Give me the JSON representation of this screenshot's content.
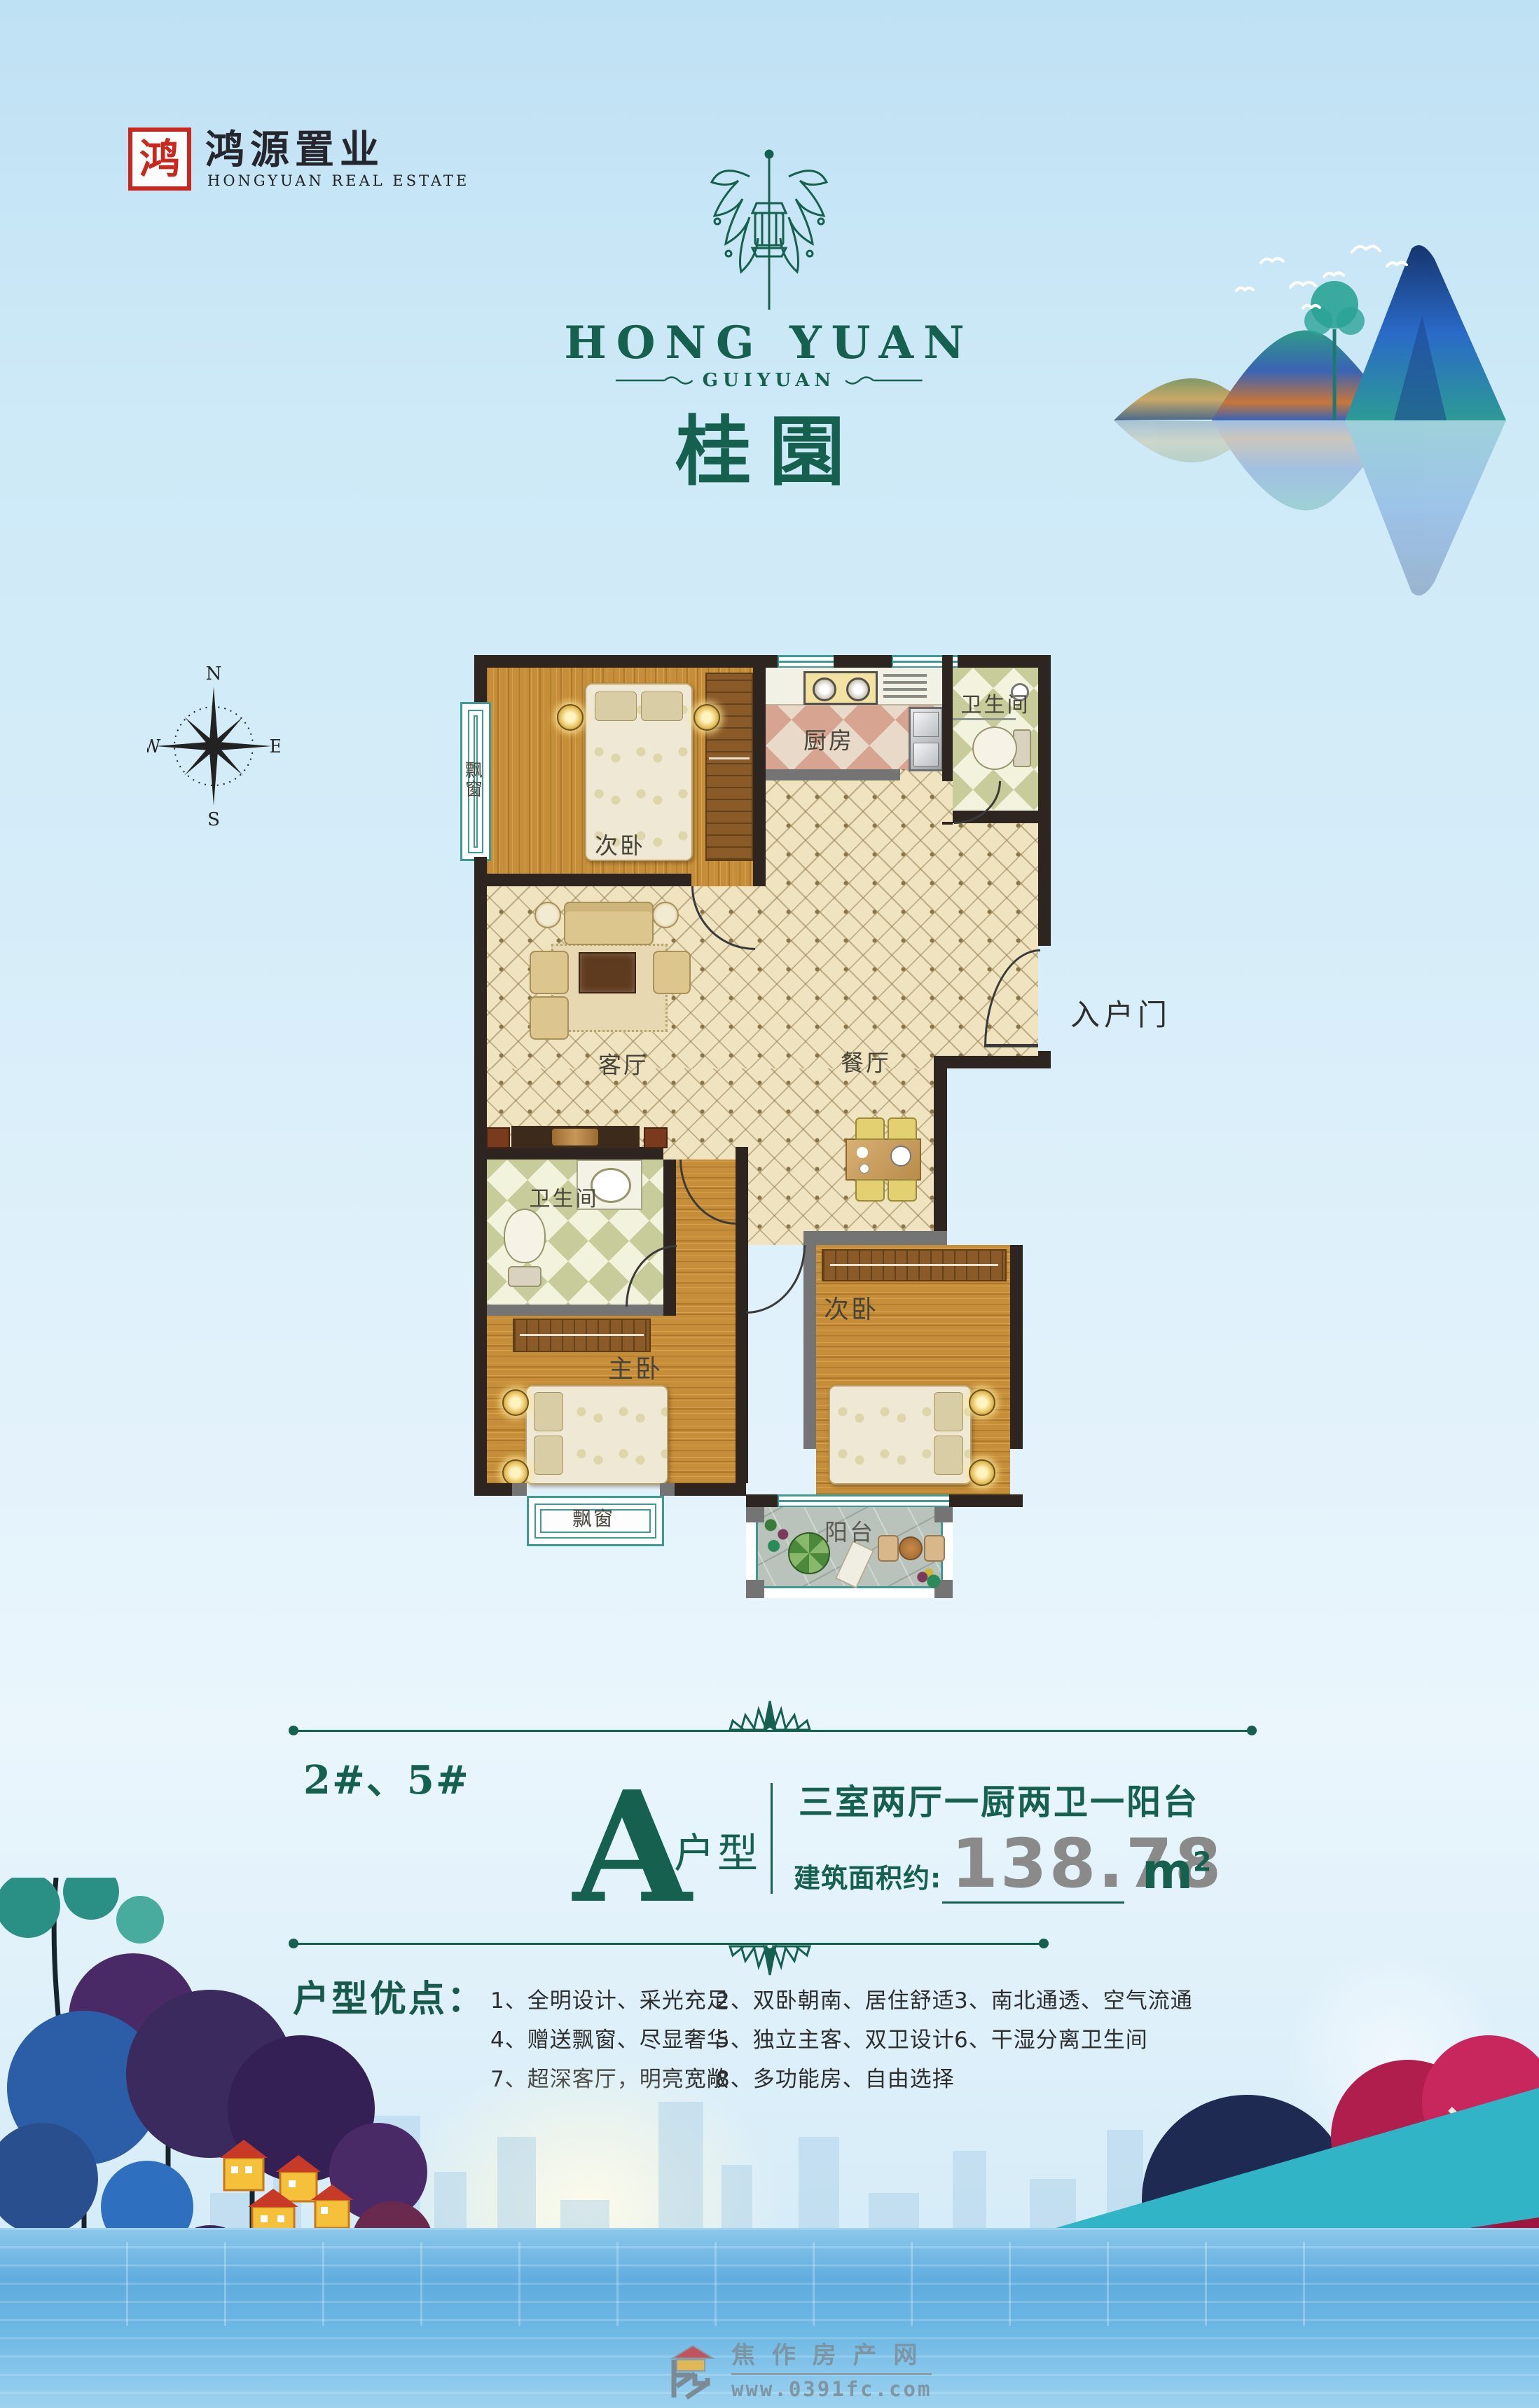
{
  "header": {
    "company_cn": "鸿源置业",
    "company_en": "HONGYUAN REAL ESTATE",
    "seal_char": "鸿"
  },
  "brand": {
    "name_en": "HONG YUAN",
    "sub_name": "GUIYUAN",
    "name_cn": "桂園"
  },
  "compass": {
    "north": "N",
    "south": "S",
    "east": "E",
    "west": "W"
  },
  "plan": {
    "bedroom_top": "次卧",
    "kitchen": "厨房",
    "bathroom_top": "卫生间",
    "living": "客厅",
    "dining": "餐厅",
    "entry_door": "入户门",
    "bathroom_bottom": "卫生间",
    "master": "主卧",
    "bedroom_bottom": "次卧",
    "balcony": "阳台",
    "bay_left": "飘窗",
    "bay_bottom": "飘窗"
  },
  "info": {
    "building_no": "2#、5#",
    "unit_letter": "A",
    "unit_type": "户型",
    "layout": "三室两厅一厨两卫一阳台",
    "area_label": "建筑面积约:",
    "area_value": "138.78",
    "unit_m": "m",
    "unit_sup": "2"
  },
  "advantages": {
    "title": "户型优点：",
    "items": [
      "1、全明设计、采光充足",
      "2、双卧朝南、居住舒适",
      "3、南北通透、空气流通",
      "4、赠送飘窗、尽显奢华",
      "5、独立主客、双卫设计",
      "6、干湿分离卫生间",
      "7、超深客厅，明亮宽敞",
      "8、多功能房、自由选择"
    ]
  },
  "watermark": {
    "name": "焦 作 房 产 网",
    "url": "www.0391fc.com"
  },
  "colors": {
    "brand_green": "#15604e",
    "area_gray": "#8a8a8a",
    "wall_dark": "#2e2520",
    "seal_red": "#c8281e",
    "swoosh_teal": "#31b4c6"
  }
}
